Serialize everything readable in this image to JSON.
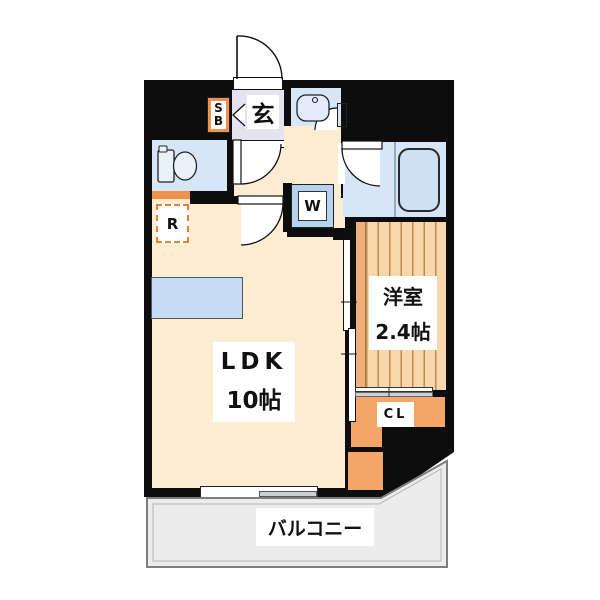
{
  "floorplan": {
    "labels": {
      "ldk_name": "LDK",
      "ldk_size": "10帖",
      "western_room_name": "洋室",
      "western_room_size": "2.4帖",
      "balcony": "バルコニー",
      "entrance": "玄",
      "closet": "CL",
      "washer": "W",
      "refrigerator": "R",
      "shoe_box_line1": "S",
      "shoe_box_line2": "B"
    },
    "colors": {
      "wall": "#0d0d0d",
      "floor_cream": "#fcecd2",
      "wet_area_blue": "#d6e6f7",
      "accent_orange": "#f09150",
      "closet_orange": "#f3a667",
      "wood_floor": "#f8d8ab",
      "genkan_lavender": "#e4e3ef",
      "balcony_gray": "#ececec"
    }
  }
}
